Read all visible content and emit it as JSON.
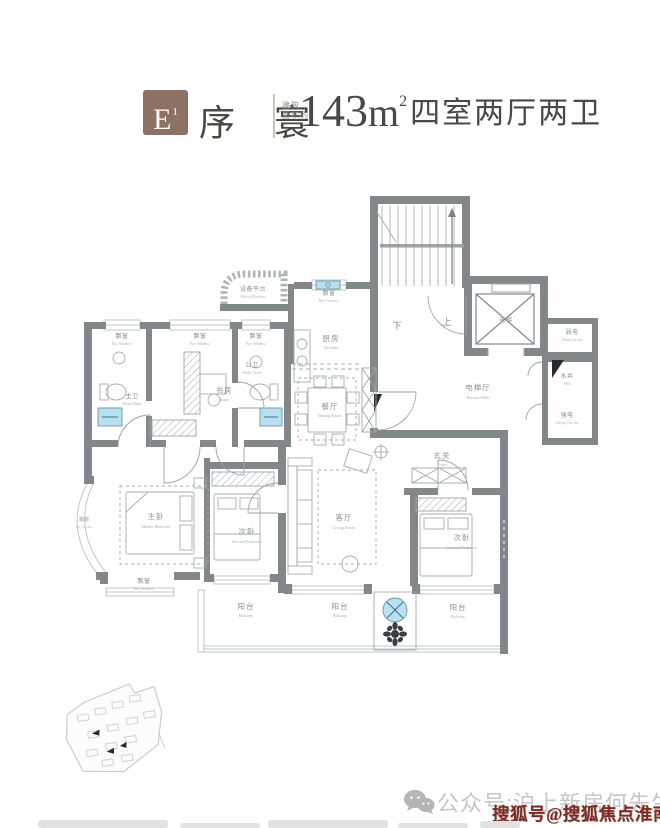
{
  "header": {
    "badge_main": "E",
    "badge_sup": "1",
    "name": "序 寰",
    "area_note_line1": "建筑",
    "area_note_line2": "面积约",
    "area_number": "143",
    "area_unit": "m",
    "area_sup": "2",
    "spec": "四室两厅两卫"
  },
  "plan": {
    "rooms": {
      "device_platform": {
        "zh": "设备平台",
        "en": "Device Platform"
      },
      "bay_window": {
        "zh": "飘窗",
        "en": "Bay Window"
      },
      "kitchen": {
        "zh": "厨房",
        "en": "Kitchen"
      },
      "master_bath": {
        "zh": "主卫",
        "en": "Master Bath"
      },
      "study": {
        "zh": "书房",
        "en": "Study"
      },
      "public_toilet": {
        "zh": "公卫",
        "en": "Public Toilet"
      },
      "stair_down": "下",
      "stair_up": "上",
      "elevator": {
        "zh": "电梯"
      },
      "weak_current": {
        "zh": "弱电",
        "en": "Weak Current"
      },
      "elevator_hall": {
        "zh": "电梯厅",
        "en": "Elevator Hall"
      },
      "water_well": {
        "zh": "水井",
        "en": "Well"
      },
      "strong_current": {
        "zh": "强电",
        "en": "Strong Current"
      },
      "foyer": {
        "zh": "玄关",
        "en": "Foyer"
      },
      "dining": {
        "zh": "餐厅",
        "en": "Dining Room"
      },
      "living": {
        "zh": "客厅",
        "en": "Living Room"
      },
      "master_bedroom": {
        "zh": "主卧",
        "en": "Master Bedroom"
      },
      "second_bedroom": {
        "zh": "次卧",
        "en": "Second Bedroom"
      },
      "balcony": {
        "zh": "阳台",
        "en": "Balcony"
      }
    }
  },
  "footer": {
    "wechat_text": "公众号:沪上新房何先生",
    "watermark": "搜狐号@搜狐焦点淮南站"
  },
  "colors": {
    "badge_brown": "#8c7164",
    "wall_gray": "#82878a",
    "accent_blue": "#b9e0ec",
    "watermark_red": "#7e2b24"
  }
}
